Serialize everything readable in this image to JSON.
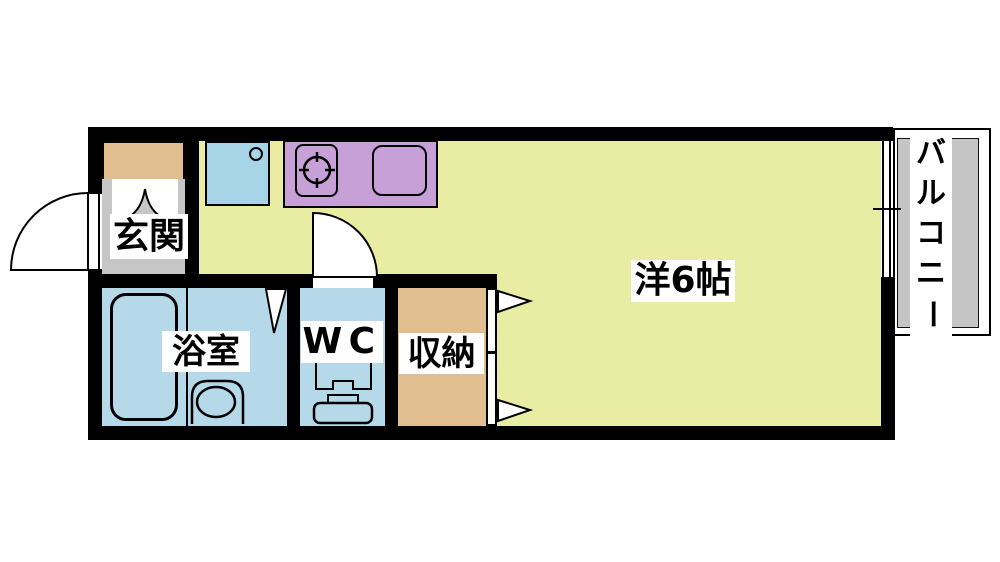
{
  "type": "apartment-floor-plan",
  "labels": {
    "entrance": "玄関",
    "bathroom": "浴室",
    "toilet": "WC",
    "storage": "収納",
    "main_room": "洋6帖",
    "balcony": "バルコニー"
  },
  "balcony_chars": [
    "バ",
    "ル",
    "コ",
    "ニ",
    "ー"
  ],
  "rooms": [
    {
      "name": "entrance",
      "label": "玄関",
      "floor": "gray"
    },
    {
      "name": "kitchen-main-room",
      "label": "洋6帖",
      "floor": "yellow-green"
    },
    {
      "name": "bathroom",
      "label": "浴室",
      "floor": "light-blue"
    },
    {
      "name": "toilet",
      "label": "WC",
      "floor": "light-blue"
    },
    {
      "name": "storage",
      "label": "収納",
      "floor": "tan"
    },
    {
      "name": "balcony",
      "label": "バルコニー",
      "floor": "gray"
    }
  ],
  "colors": {
    "wall": "#000000",
    "room_yellow": "#e9eda4",
    "water_blue": "#b6d9e9",
    "sink_blue": "#a8d4e8",
    "counter_purple": "#c8a0d8",
    "wood_tan": "#e0be90",
    "floor_gray": "#c6c6c6",
    "balcony_gray": "#c5c5c5",
    "label_bg": "#ffffff",
    "text": "#000000"
  }
}
